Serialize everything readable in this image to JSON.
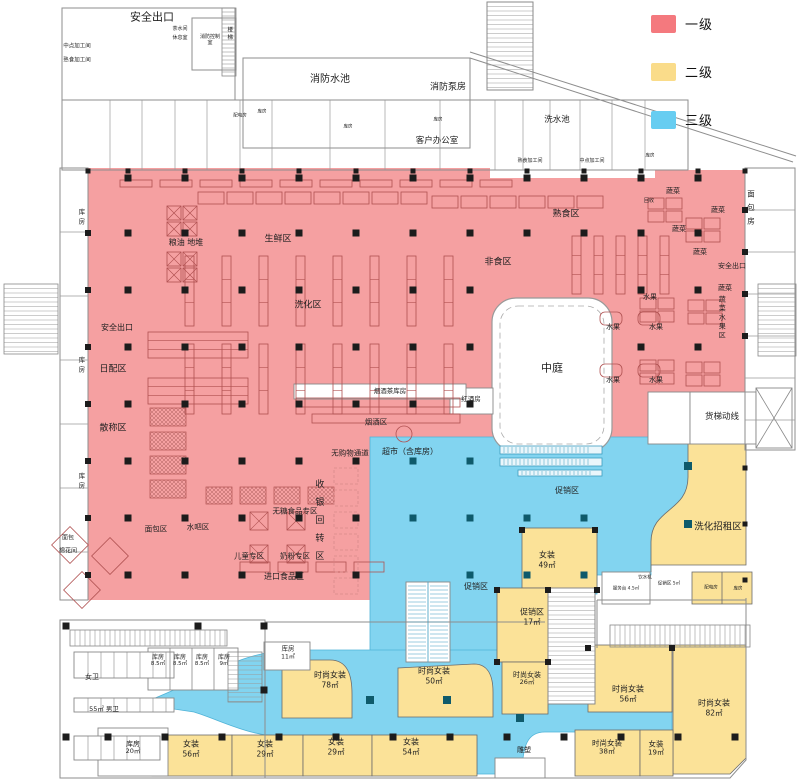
{
  "legend": {
    "items": [
      {
        "label": "一级",
        "color": "#F4797E"
      },
      {
        "label": "二级",
        "color": "#FADC8A"
      },
      {
        "label": "三级",
        "color": "#67CDF1"
      }
    ]
  },
  "palette": {
    "zone_first": "#F5A0A1",
    "zone_second": "#FBE298",
    "zone_third": "#82D4F0",
    "column": "#1c1c1c",
    "column_blue": "#0e5a6b",
    "shelf": "#b05151",
    "wall": "#8d8d8d",
    "corridor": "#4fb3d7"
  },
  "labels": [
    {
      "n": "exit-top-left",
      "t": "安全出口",
      "x": 152,
      "y": 17,
      "s": 11
    },
    {
      "n": "room-midpoint-proc-1",
      "t": "中点加工间",
      "x": 77,
      "y": 47,
      "s": 5.5
    },
    {
      "n": "room-cooked-proc-1",
      "t": "熟食加工间",
      "x": 77,
      "y": 61,
      "s": 5.5
    },
    {
      "n": "room-tea",
      "t": "茶水间",
      "x": 180,
      "y": 29,
      "s": 5
    },
    {
      "n": "room-rest",
      "t": "休息室",
      "x": 180,
      "y": 38,
      "s": 5
    },
    {
      "n": "room-fire-control",
      "t": "消防控制室",
      "x": 210,
      "y": 40,
      "s": 5,
      "w": 22
    },
    {
      "n": "stair-top-left",
      "t": "楼梯",
      "x": 229,
      "y": 34,
      "s": 5.5,
      "v": true,
      "ls": 2
    },
    {
      "n": "fire-pool",
      "t": "消防水池",
      "x": 330,
      "y": 80,
      "s": 10
    },
    {
      "n": "fire-pump-room",
      "t": "消防泵房",
      "x": 448,
      "y": 88,
      "s": 9
    },
    {
      "n": "wash-pool",
      "t": "洗水池",
      "x": 557,
      "y": 120,
      "s": 8.5
    },
    {
      "n": "client-office",
      "t": "客户办公室",
      "x": 437,
      "y": 141,
      "s": 8.5
    },
    {
      "n": "room-elec-top",
      "t": "配电房",
      "x": 240,
      "y": 116,
      "s": 4.5
    },
    {
      "n": "room-store-t1",
      "t": "库房",
      "x": 262,
      "y": 112,
      "s": 4.5
    },
    {
      "n": "room-store-t2",
      "t": "库房",
      "x": 348,
      "y": 127,
      "s": 4.5
    },
    {
      "n": "room-store-t3",
      "t": "库房",
      "x": 438,
      "y": 120,
      "s": 4.5
    },
    {
      "n": "room-cooked-proc-2",
      "t": "熟食加工间",
      "x": 530,
      "y": 161,
      "s": 5
    },
    {
      "n": "room-midpoint-proc-2",
      "t": "中点加工间",
      "x": 592,
      "y": 161,
      "s": 5
    },
    {
      "n": "room-store-t4",
      "t": "库房",
      "x": 650,
      "y": 156,
      "s": 4.5
    },
    {
      "n": "store-left-1",
      "t": "库房",
      "x": 80,
      "y": 218,
      "s": 6.5,
      "v": true,
      "ls": 3
    },
    {
      "n": "store-left-2",
      "t": "库房",
      "x": 80,
      "y": 366,
      "s": 6.5,
      "v": true,
      "ls": 3
    },
    {
      "n": "store-left-3",
      "t": "库房",
      "x": 80,
      "y": 482,
      "s": 6.5,
      "v": true,
      "ls": 3
    },
    {
      "n": "bread-room-left",
      "t": "面包",
      "x": 68,
      "y": 538,
      "s": 6
    },
    {
      "n": "cotton-room-left",
      "t": "棉花间",
      "x": 68,
      "y": 551,
      "s": 6
    },
    {
      "n": "zone-fresh",
      "t": "生鲜区",
      "x": 278,
      "y": 240,
      "s": 9
    },
    {
      "n": "zone-grain-pile",
      "t": "粮油 地堆",
      "x": 186,
      "y": 243,
      "s": 8
    },
    {
      "n": "zone-cooked-food",
      "t": "熟食区",
      "x": 566,
      "y": 215,
      "s": 9
    },
    {
      "n": "recycle",
      "t": "回收",
      "x": 649,
      "y": 201,
      "s": 5
    },
    {
      "n": "zone-nonfood",
      "t": "非食区",
      "x": 498,
      "y": 263,
      "s": 9
    },
    {
      "n": "zone-washcare",
      "t": "洗化区",
      "x": 308,
      "y": 306,
      "s": 9
    },
    {
      "n": "exit-left",
      "t": "安全出口",
      "x": 117,
      "y": 328,
      "s": 8
    },
    {
      "n": "zone-daily",
      "t": "日配区",
      "x": 113,
      "y": 370,
      "s": 9
    },
    {
      "n": "zone-bulk",
      "t": "散称区",
      "x": 113,
      "y": 429,
      "s": 9
    },
    {
      "n": "tobacco-tea-storeroom",
      "t": "烟酒茶库房",
      "x": 390,
      "y": 392,
      "s": 6.5
    },
    {
      "n": "red-wine-room",
      "t": "红酒房",
      "x": 471,
      "y": 400,
      "s": 6.5
    },
    {
      "n": "zone-tobacco-liquor",
      "t": "烟酒区",
      "x": 376,
      "y": 422,
      "s": 7.5
    },
    {
      "n": "atrium",
      "t": "中庭",
      "x": 552,
      "y": 368,
      "s": 11
    },
    {
      "n": "veg-1",
      "t": "蔬菜",
      "x": 673,
      "y": 191,
      "s": 7
    },
    {
      "n": "veg-2",
      "t": "蔬菜",
      "x": 718,
      "y": 210,
      "s": 7
    },
    {
      "n": "veg-3",
      "t": "蔬菜",
      "x": 679,
      "y": 229,
      "s": 7
    },
    {
      "n": "veg-4",
      "t": "蔬菜",
      "x": 700,
      "y": 252,
      "s": 7
    },
    {
      "n": "veg-5",
      "t": "蔬菜",
      "x": 725,
      "y": 288,
      "s": 7
    },
    {
      "n": "fruit-1",
      "t": "水果",
      "x": 650,
      "y": 297,
      "s": 7
    },
    {
      "n": "fruit-2",
      "t": "水果",
      "x": 613,
      "y": 327,
      "s": 7
    },
    {
      "n": "fruit-3",
      "t": "水果",
      "x": 656,
      "y": 327,
      "s": 7
    },
    {
      "n": "fruit-4",
      "t": "水果",
      "x": 613,
      "y": 380,
      "s": 7
    },
    {
      "n": "fruit-5",
      "t": "水果",
      "x": 656,
      "y": 380,
      "s": 7
    },
    {
      "n": "veg-fruit-vertical",
      "t": "蔬菜水果区",
      "x": 722,
      "y": 318,
      "s": 7,
      "v": true,
      "ls": 2
    },
    {
      "n": "exit-right",
      "t": "安全出口",
      "x": 732,
      "y": 266,
      "s": 7
    },
    {
      "n": "bread-room-right",
      "t": "面包房",
      "x": 751,
      "y": 210,
      "s": 7.5,
      "v": true,
      "ls": 6
    },
    {
      "n": "checkout-turn-zone",
      "t": "收银回转区",
      "x": 318,
      "y": 524,
      "s": 9,
      "v": true,
      "ls": 9
    },
    {
      "n": "no-shopping-passage",
      "t": "无购物通道",
      "x": 350,
      "y": 453,
      "s": 7.5
    },
    {
      "n": "supermarket-with-storage",
      "t": "超市（含库房）",
      "x": 410,
      "y": 452,
      "s": 8
    },
    {
      "n": "sugar-free-zone",
      "t": "无糖食品专区",
      "x": 295,
      "y": 511,
      "s": 7.5
    },
    {
      "n": "bread-zone",
      "t": "面包区",
      "x": 156,
      "y": 529,
      "s": 7.5
    },
    {
      "n": "water-bar-zone",
      "t": "水吧区",
      "x": 198,
      "y": 527,
      "s": 7.5
    },
    {
      "n": "kids-zone",
      "t": "儿童专区",
      "x": 249,
      "y": 556,
      "s": 7.5
    },
    {
      "n": "milk-powder-zone",
      "t": "奶粉专区",
      "x": 295,
      "y": 556,
      "s": 7.5
    },
    {
      "n": "import-food-zone",
      "t": "进口食品区",
      "x": 284,
      "y": 577,
      "s": 8
    },
    {
      "n": "promo-zone-1",
      "t": "促销区",
      "x": 567,
      "y": 491,
      "s": 8
    },
    {
      "n": "promo-zone-2",
      "t": "促销区",
      "x": 476,
      "y": 587,
      "s": 8
    },
    {
      "n": "freight-elevator-route",
      "t": "货梯动线",
      "x": 722,
      "y": 417,
      "s": 8.5
    },
    {
      "n": "wash-rental-zone",
      "t": "洗化招租区",
      "x": 718,
      "y": 527,
      "s": 9.5
    },
    {
      "n": "service-desk",
      "t": "服务台 4.5㎡",
      "x": 626,
      "y": 589,
      "s": 4.5
    },
    {
      "n": "water-dispenser",
      "t": "饮水机",
      "x": 645,
      "y": 578,
      "s": 4.5
    },
    {
      "n": "promo-small",
      "t": "促销区 5㎡",
      "x": 669,
      "y": 584,
      "s": 4.5
    },
    {
      "n": "elec-room-2",
      "t": "配电房",
      "x": 711,
      "y": 588,
      "s": 4.5
    },
    {
      "n": "storeroom-small-right",
      "t": "库房",
      "x": 738,
      "y": 589,
      "s": 4.5
    },
    {
      "n": "sculpture",
      "t": "雕塑",
      "x": 524,
      "y": 750,
      "s": 7
    },
    {
      "n": "shop-nz-49",
      "t": "女装",
      "sub": "49㎡",
      "x": 547,
      "y": 560,
      "s": 8
    },
    {
      "n": "shop-promo-17",
      "t": "促销区",
      "sub": "17㎡",
      "x": 532,
      "y": 617,
      "s": 8
    },
    {
      "n": "shop-ssnz-78",
      "t": "时尚女装",
      "sub": "78㎡",
      "x": 330,
      "y": 680,
      "s": 8
    },
    {
      "n": "shop-ssnz-50",
      "t": "时尚女装",
      "sub": "50㎡",
      "x": 434,
      "y": 676,
      "s": 8
    },
    {
      "n": "shop-ssnz-26",
      "t": "时尚女装",
      "sub": "26㎡",
      "x": 527,
      "y": 679,
      "s": 7
    },
    {
      "n": "shop-ssnz-56",
      "t": "时尚女装",
      "sub": "56㎡",
      "x": 628,
      "y": 694,
      "s": 8
    },
    {
      "n": "shop-ssnz-82",
      "t": "时尚女装",
      "sub": "82㎡",
      "x": 714,
      "y": 708,
      "s": 8
    },
    {
      "n": "shop-ssnz-38",
      "t": "时尚女装",
      "sub": "38㎡",
      "x": 607,
      "y": 747,
      "s": 7.5
    },
    {
      "n": "shop-nz-19",
      "t": "女装",
      "sub": "19㎡",
      "x": 656,
      "y": 748,
      "s": 7.5
    },
    {
      "n": "shop-nz-56",
      "t": "女装",
      "sub": "56㎡",
      "x": 191,
      "y": 749,
      "s": 8
    },
    {
      "n": "shop-nz-29a",
      "t": "女装",
      "sub": "29㎡",
      "x": 265,
      "y": 749,
      "s": 8
    },
    {
      "n": "shop-nz-29b",
      "t": "女装",
      "sub": "29㎡",
      "x": 336,
      "y": 747,
      "s": 8
    },
    {
      "n": "shop-nz-54",
      "t": "女装",
      "sub": "54㎡",
      "x": 411,
      "y": 747,
      "s": 8
    },
    {
      "n": "storeroom-11",
      "t": "库房",
      "sub": "11㎡",
      "x": 288,
      "y": 653,
      "s": 6.5
    },
    {
      "n": "storeroom-85a",
      "t": "库房",
      "sub": "8.5㎡",
      "x": 158,
      "y": 661,
      "s": 6
    },
    {
      "n": "storeroom-85b",
      "t": "库房",
      "sub": "8.5㎡",
      "x": 180,
      "y": 661,
      "s": 6
    },
    {
      "n": "storeroom-85c",
      "t": "库房",
      "sub": "8.5㎡",
      "x": 202,
      "y": 661,
      "s": 6
    },
    {
      "n": "storeroom-9",
      "t": "库房",
      "sub": "9㎡",
      "x": 224,
      "y": 661,
      "s": 6
    },
    {
      "n": "storeroom-20",
      "t": "库房",
      "sub": "20㎡",
      "x": 133,
      "y": 748,
      "s": 7
    },
    {
      "n": "womens-wc",
      "t": "女卫",
      "x": 92,
      "y": 677,
      "s": 7
    },
    {
      "n": "mens-wc",
      "t": "55㎡ 男卫",
      "x": 104,
      "y": 710,
      "s": 6.5
    }
  ]
}
